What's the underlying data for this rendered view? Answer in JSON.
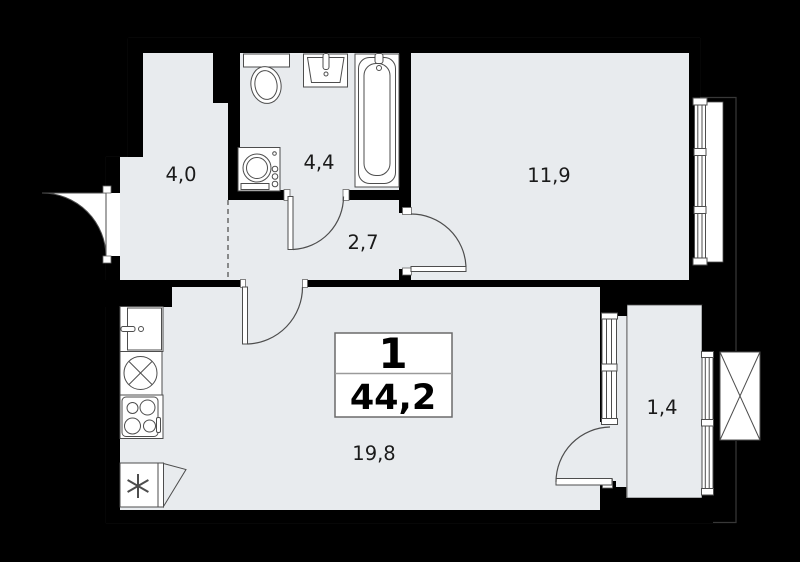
{
  "badge": {
    "rooms_count": "1",
    "total_area": "44,2"
  },
  "rooms": {
    "hallway": {
      "area": "4,0"
    },
    "bathroom": {
      "area": "4,4"
    },
    "hall": {
      "area": "2,7"
    },
    "bedroom": {
      "area": "11,9"
    },
    "living_kitchen": {
      "area": "19,8"
    },
    "balcony": {
      "area": "1,4"
    }
  },
  "fixtures": [
    "toilet",
    "bathroom-sink",
    "bathtub",
    "washing-machine",
    "kitchen-sink",
    "round-sink-hob",
    "stove",
    "refrigerator",
    "entrance-door",
    "bathroom-door",
    "living-room-door",
    "bedroom-door",
    "balcony-door",
    "bedroom-window",
    "balcony-window",
    "ac-unit-spot"
  ],
  "colors": {
    "background": "#000000",
    "wall": "#000000",
    "floor": "#e8ebee",
    "fixture": "#ffffff",
    "line": "#4d4d4d",
    "label": "#1a1a1a"
  }
}
